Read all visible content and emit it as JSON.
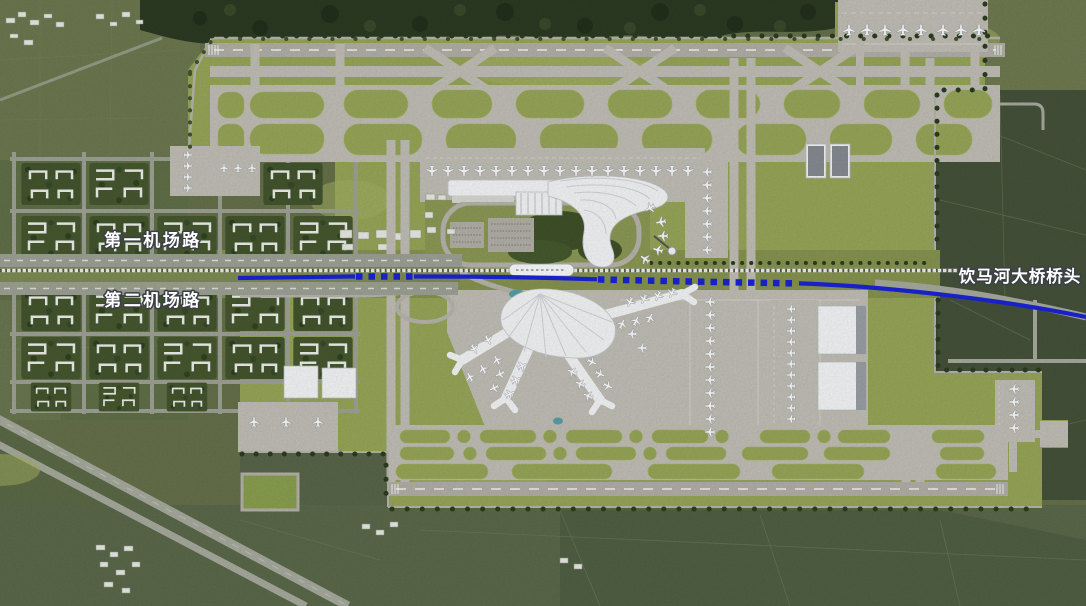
{
  "scene": {
    "annotations": [
      {
        "id": "first-airport-road",
        "text": "第一机场路",
        "x": 153,
        "y": 246
      },
      {
        "id": "second-airport-road",
        "text": "第二机场路",
        "x": 153,
        "y": 306
      },
      {
        "id": "yinma-river-bridge-head",
        "text": "饮马河大桥桥头",
        "x": 1020,
        "y": 282
      }
    ],
    "palette": {
      "farmland": "#66714a",
      "farmland_dark": "#45523a",
      "forest": "#2c3a23",
      "airfield_grass": "#97a659",
      "pavement": "#c1bfb6",
      "runway": "#adaba2",
      "terminal_white": "#f4f6f7",
      "route_blue": "#1a23d6",
      "railway_tie": "#3c4042",
      "label_fill": "#ffffff",
      "label_outline": "#3b4046"
    }
  }
}
